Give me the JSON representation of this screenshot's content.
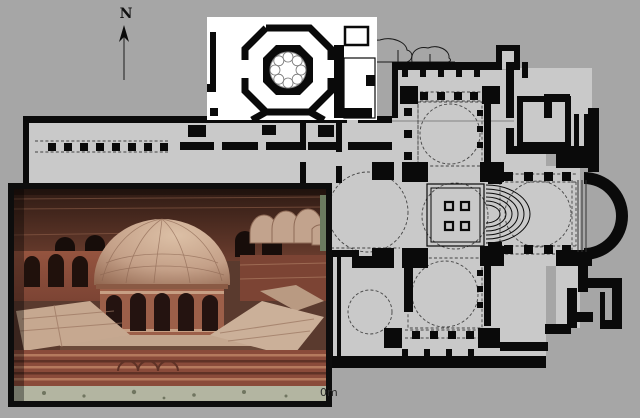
{
  "meta": {
    "description": "Archaeological composite: Byzantine church floor plan on gray background, octagonal structure detail inset (white panel), and photograph of a brick architectural model with central dome",
    "visible_texts": [
      "N",
      "0m"
    ]
  },
  "north_indicator": {
    "label": "N"
  },
  "scale_bar": {
    "label": "0m"
  },
  "colors": {
    "background": "#a6a6a6",
    "plan_interior": "#c9c9c9",
    "wall_black": "#0a0a0a",
    "dashed_line": "#444444",
    "inset_panel": "#ffffff",
    "photo_border": "#0d0d0d",
    "brick_dark": "#5a3325",
    "brick_mid": "#8a4b3a",
    "brick_light": "#b57a5e",
    "roof_tile": "#c6a890",
    "dome_tan": "#cfae94",
    "window_dark": "#241310",
    "ground_green": "#b3b5a1"
  },
  "regions": {
    "floor_plan": "main church floor plan",
    "octagon_inset": "octagonal hall detail plan",
    "model_photo": "photograph of brick model with ribbed dome",
    "north_arrow": "north direction arrow"
  }
}
